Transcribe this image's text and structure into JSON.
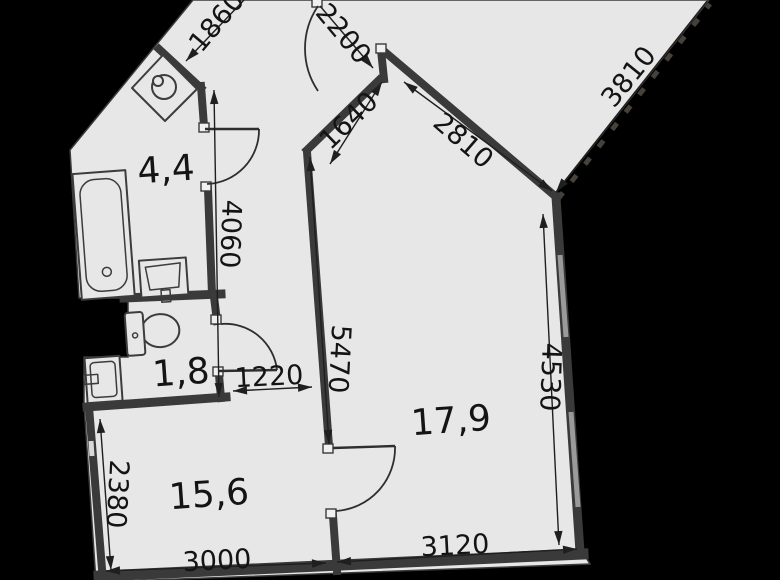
{
  "plan": {
    "type": "apartment-floor-plan",
    "rooms": [
      {
        "name": "bathroom",
        "area": "4,4"
      },
      {
        "name": "wc",
        "area": "1,8"
      },
      {
        "name": "living-room",
        "area": "15,6"
      },
      {
        "name": "room",
        "area": "17,9"
      }
    ],
    "dimensions": {
      "d1860": "1860",
      "d2200": "2200",
      "d1640": "1640",
      "d2810": "2810",
      "d3810": "3810",
      "d4060": "4060",
      "d5470": "5470",
      "d4530": "4530",
      "d1220": "1220",
      "d2380": "2380",
      "d3000": "3000",
      "d3120": "3120"
    },
    "fixtures": [
      "bathtub",
      "sink",
      "toilet",
      "washbasin",
      "washing-machine"
    ],
    "colors": {
      "background": "#000000",
      "floor": "#e7e7e7",
      "walls": "#3a3a3a",
      "text": "#141414"
    }
  }
}
